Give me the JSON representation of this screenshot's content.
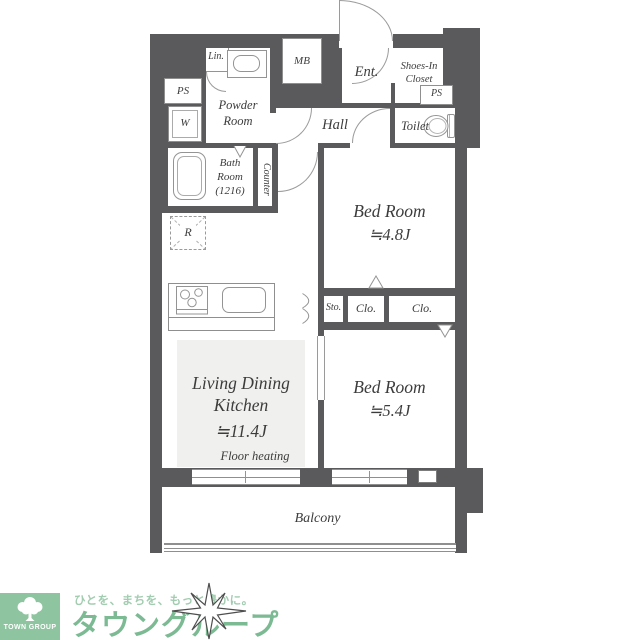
{
  "plan": {
    "labels": {
      "lin": "Lin.",
      "ps_left": "PS",
      "washer": "W",
      "powder_room": "Powder\nRoom",
      "mb": "MB",
      "entrance": "Ent.",
      "shoes_in_closet": "Shoes-In\nCloset",
      "ps_right": "PS",
      "hall": "Hall",
      "toilet": "Toilet",
      "bath_room": "Bath\nRoom\n(1216)",
      "counter": "Counter",
      "refrigerator": "R",
      "storage": "Sto.",
      "closet_1": "Clo.",
      "closet_2": "Clo.",
      "floor_heating": "Floor heating",
      "balcony": "Balcony"
    },
    "rooms": {
      "bedroom_1": {
        "name": "Bed Room",
        "size": "≒4.8J"
      },
      "bedroom_2": {
        "name": "Bed Room",
        "size": "≒5.4J"
      },
      "ldk": {
        "name": "Living Dining\nKitchen",
        "size": "≒11.4J"
      }
    },
    "colors": {
      "wall": "#5a5a5c",
      "ldk_floor": "#f0f0ee",
      "line": "#949494"
    }
  },
  "footer": {
    "company": "TOWN GROUP",
    "tagline": "ひとを、まちを、もっと豊かに。",
    "brand": "タウングループ",
    "colors": {
      "logo_bg": "#8ec49f",
      "brand_text": "#7cba93",
      "tagline_text": "#a2ccb0"
    }
  }
}
